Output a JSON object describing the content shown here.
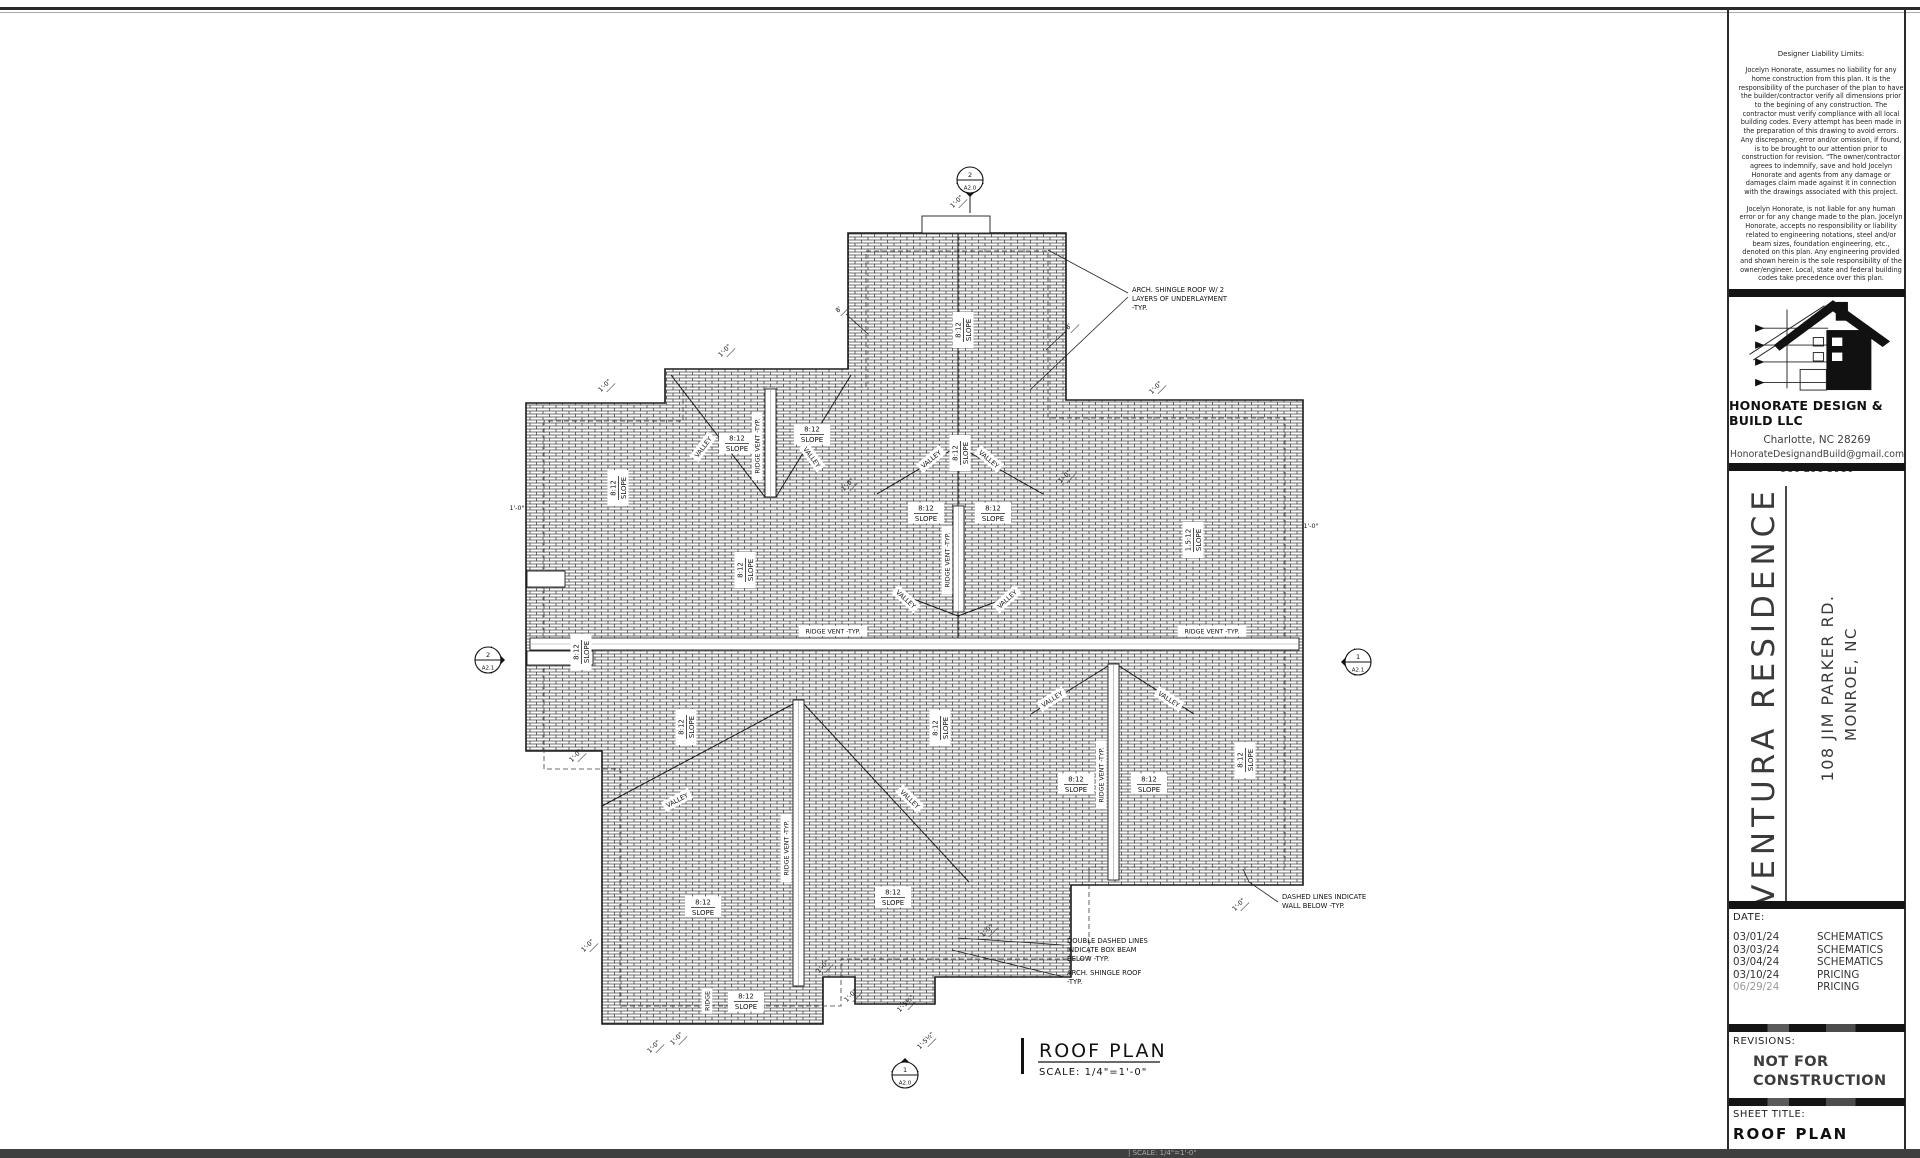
{
  "colors": {
    "line": "#1a1a1a",
    "sheet": "#ffffff",
    "bar": "#141414",
    "muted_date": "#9a9a9a"
  },
  "title_block": {
    "liability": {
      "heading": "Designer Liability Limits:",
      "p1": "Jocelyn Honorate, assumes no liability for any home construction from this plan. It is the responsibility of the purchaser of the plan to have the builder/contractor verify all dimensions prior to the begining of any construction. The contractor must verify compliance with all local building codes. Every attempt has been made in the preparation of this drawing to avoid errors. Any discrepancy, error and/or omission, if found, is to be brought to our attention prior to construction for revision. \"The owner/contractor agrees to indemnify, save and hold Jocelyn Honorate and agents from any damage or damages claim made against it in connection with the drawings associated with this project.",
      "p2": "Jocelyn Honorate, is not liable for any human error or for any change made to the plan. Jocelyn Honorate, accepts no responsibility or liability related to engineering notations, steel and/or beam sizes, foundation engineering, etc., denoted on this plan. Any engineering provided and shown herein is the sole responsibility of the owner/engineer. Local, state and federal building codes take precedence over this plan."
    },
    "company": {
      "name": "HONORATE DESIGN & BUILD LLC",
      "city": "Charlotte, NC 28269",
      "email": "HonorateDesignandBuild@gmail.com",
      "phone": "980 298 3980"
    },
    "project": {
      "name": "VENTURA RESIDENCE",
      "address_line1": "108 JIM PARKER RD.",
      "address_line2": "MONROE, NC"
    },
    "date_section": {
      "label": "DATE:",
      "rows": [
        {
          "date": "03/01/24",
          "type": "SCHEMATICS"
        },
        {
          "date": "03/03/24",
          "type": "SCHEMATICS"
        },
        {
          "date": "03/04/24",
          "type": "SCHEMATICS"
        },
        {
          "date": "03/10/24",
          "type": "PRICING"
        },
        {
          "date": "06/29/24",
          "type": "PRICING"
        }
      ]
    },
    "revisions": {
      "label": "REVISIONS:",
      "stamp_line1": "NOT FOR",
      "stamp_line2": "CONSTRUCTION"
    },
    "sheet_title": {
      "label": "SHEET TITLE:",
      "value": "ROOF PLAN"
    }
  },
  "footer_strip": {
    "text": "|   SCALE:  1/4\"=1'-0\""
  },
  "plan": {
    "title": {
      "text": "ROOF PLAN",
      "scale": "SCALE:  1/4\"=1'-0\""
    },
    "slope_label": {
      "top": "8:12",
      "bottom": "SLOPE"
    },
    "low_slope_label": {
      "top": "1.5:12",
      "bottom": "SLOPE"
    },
    "valley_text": "VALLEY",
    "ridge_vent_text": "RIDGE VENT -TYP.",
    "ridge_text": "RIDGE",
    "dim_default": "1'-0\"",
    "outline": [
      [
        848,
        233
      ],
      [
        1066,
        233
      ],
      [
        1066,
        400
      ],
      [
        1303,
        400
      ],
      [
        1303,
        885
      ],
      [
        1071,
        885
      ],
      [
        1071,
        977
      ],
      [
        935,
        977
      ],
      [
        935,
        1004
      ],
      [
        855,
        1004
      ],
      [
        855,
        977
      ],
      [
        823,
        977
      ],
      [
        823,
        1024
      ],
      [
        602,
        1024
      ],
      [
        602,
        751
      ],
      [
        526,
        751
      ],
      [
        526,
        403
      ],
      [
        665,
        403
      ],
      [
        665,
        369
      ],
      [
        848,
        369
      ]
    ],
    "inset": [
      [
        866,
        251
      ],
      [
        1048,
        251
      ],
      [
        1048,
        418
      ],
      [
        1285,
        418
      ],
      [
        1285,
        867
      ],
      [
        1089,
        867
      ],
      [
        1089,
        959
      ],
      [
        841,
        959
      ],
      [
        841,
        1006
      ],
      [
        620,
        1006
      ],
      [
        620,
        769
      ],
      [
        544,
        769
      ],
      [
        544,
        421
      ],
      [
        683,
        421
      ],
      [
        683,
        387
      ],
      [
        866,
        387
      ]
    ],
    "lines": [
      [
        958,
        233,
        958,
        506
      ],
      [
        958,
        612,
        958,
        638
      ],
      [
        970,
        194,
        970,
        213
      ]
    ],
    "valleys": [
      [
        671,
        375,
        765,
        497
      ],
      [
        851,
        375,
        776,
        497
      ],
      [
        877,
        494,
        958,
        446
      ],
      [
        1043,
        494,
        958,
        446
      ],
      [
        900,
        594,
        958,
        616
      ],
      [
        1017,
        594,
        958,
        616
      ],
      [
        602,
        806,
        793,
        704
      ],
      [
        804,
        704,
        969,
        882
      ],
      [
        1031,
        714,
        1108,
        666
      ],
      [
        1194,
        714,
        1119,
        666
      ]
    ],
    "vents": [
      [
        530,
        638,
        769,
        12
      ],
      [
        765,
        389,
        11,
        108
      ],
      [
        953,
        506,
        11,
        106
      ],
      [
        793,
        700,
        11,
        286
      ],
      [
        1108,
        664,
        11,
        216
      ]
    ],
    "white_rects": [
      [
        922,
        216,
        68,
        17
      ],
      [
        527,
        571,
        38,
        16
      ],
      [
        527,
        651,
        66,
        14
      ]
    ],
    "slope_h": [
      [
        737,
        443
      ],
      [
        812,
        434
      ],
      [
        926,
        513
      ],
      [
        993,
        513
      ],
      [
        893,
        897
      ],
      [
        703,
        907
      ],
      [
        746,
        1001
      ],
      [
        1076,
        784
      ],
      [
        1149,
        784
      ]
    ],
    "slope_v": [
      [
        963,
        330
      ],
      [
        960,
        453
      ],
      [
        618,
        488
      ],
      [
        745,
        570
      ],
      [
        581,
        652
      ],
      [
        686,
        727
      ],
      [
        940,
        728
      ],
      [
        1245,
        760
      ]
    ],
    "low_slope_v": [
      [
        1193,
        540
      ]
    ],
    "valley_labels": [
      [
        703,
        447,
        -53
      ],
      [
        812,
        457,
        53
      ],
      [
        931,
        459,
        -40
      ],
      [
        989,
        459,
        40
      ],
      [
        906,
        599,
        42
      ],
      [
        1007,
        599,
        -42
      ],
      [
        677,
        800,
        -28
      ],
      [
        910,
        799,
        44
      ],
      [
        1052,
        699,
        -33
      ],
      [
        1169,
        699,
        33
      ]
    ],
    "ridge_vent_h": [
      [
        833,
        631
      ],
      [
        1212,
        631
      ]
    ],
    "ridge_vent_v": [
      [
        757,
        446
      ],
      [
        947,
        560
      ],
      [
        786,
        848
      ],
      [
        1101,
        775
      ]
    ],
    "ridge_v": [
      [
        707,
        1001
      ]
    ],
    "dims": [
      [
        726,
        352
      ],
      [
        606,
        387
      ],
      [
        517,
        510,
        0
      ],
      [
        1157,
        389
      ],
      [
        1311,
        528,
        0
      ],
      [
        1066,
        478
      ],
      [
        849,
        486
      ],
      [
        958,
        203
      ],
      [
        577,
        757
      ],
      [
        589,
        947
      ],
      [
        678,
        1040
      ],
      [
        824,
        968
      ],
      [
        852,
        997
      ],
      [
        1240,
        906
      ],
      [
        988,
        932
      ],
      [
        655,
        1048
      ],
      [
        907,
        1005,
        -45,
        "1'-5½\""
      ],
      [
        927,
        1042,
        -45,
        "1'-5½\""
      ],
      [
        840,
        311,
        -45,
        "8'"
      ],
      [
        1070,
        328,
        -45,
        "8'"
      ]
    ],
    "markers": [
      {
        "x": 970,
        "y": 180,
        "num": "2",
        "sheet": "A2.0",
        "dir": "down"
      },
      {
        "x": 488,
        "y": 660,
        "num": "2",
        "sheet": "A2.1",
        "dir": "right"
      },
      {
        "x": 1358,
        "y": 662,
        "num": "1",
        "sheet": "A2.1",
        "dir": "left"
      },
      {
        "x": 905,
        "y": 1075,
        "num": "1",
        "sheet": "A2.0",
        "dir": "up"
      }
    ],
    "annotations": [
      {
        "x": 1132,
        "y": 292,
        "lines": [
          "ARCH. SHINGLE ROOF W/ 2",
          "LAYERS OF UNDERLAYMENT",
          "-TYP."
        ]
      },
      {
        "x": 1282,
        "y": 899,
        "lines": [
          "DASHED LINES INDICATE",
          "WALL BELOW -TYP."
        ]
      },
      {
        "x": 1067,
        "y": 943,
        "lines": [
          "DOUBLE DASHED LINES",
          "INDICATE BOX BEAM",
          "BELOW -TYP."
        ]
      },
      {
        "x": 1067,
        "y": 975,
        "lines": [
          "ARCH. SHINGLE ROOF",
          "-TYP."
        ]
      }
    ],
    "leaders": [
      [
        1128,
        293,
        1048,
        250
      ],
      [
        1128,
        297,
        1030,
        390
      ],
      [
        1278,
        902,
        1249,
        882,
        1243,
        869
      ],
      [
        1064,
        945,
        958,
        938
      ],
      [
        1064,
        977,
        952,
        950
      ],
      [
        846,
        314,
        868,
        334
      ],
      [
        1066,
        331,
        1046,
        350
      ]
    ]
  }
}
